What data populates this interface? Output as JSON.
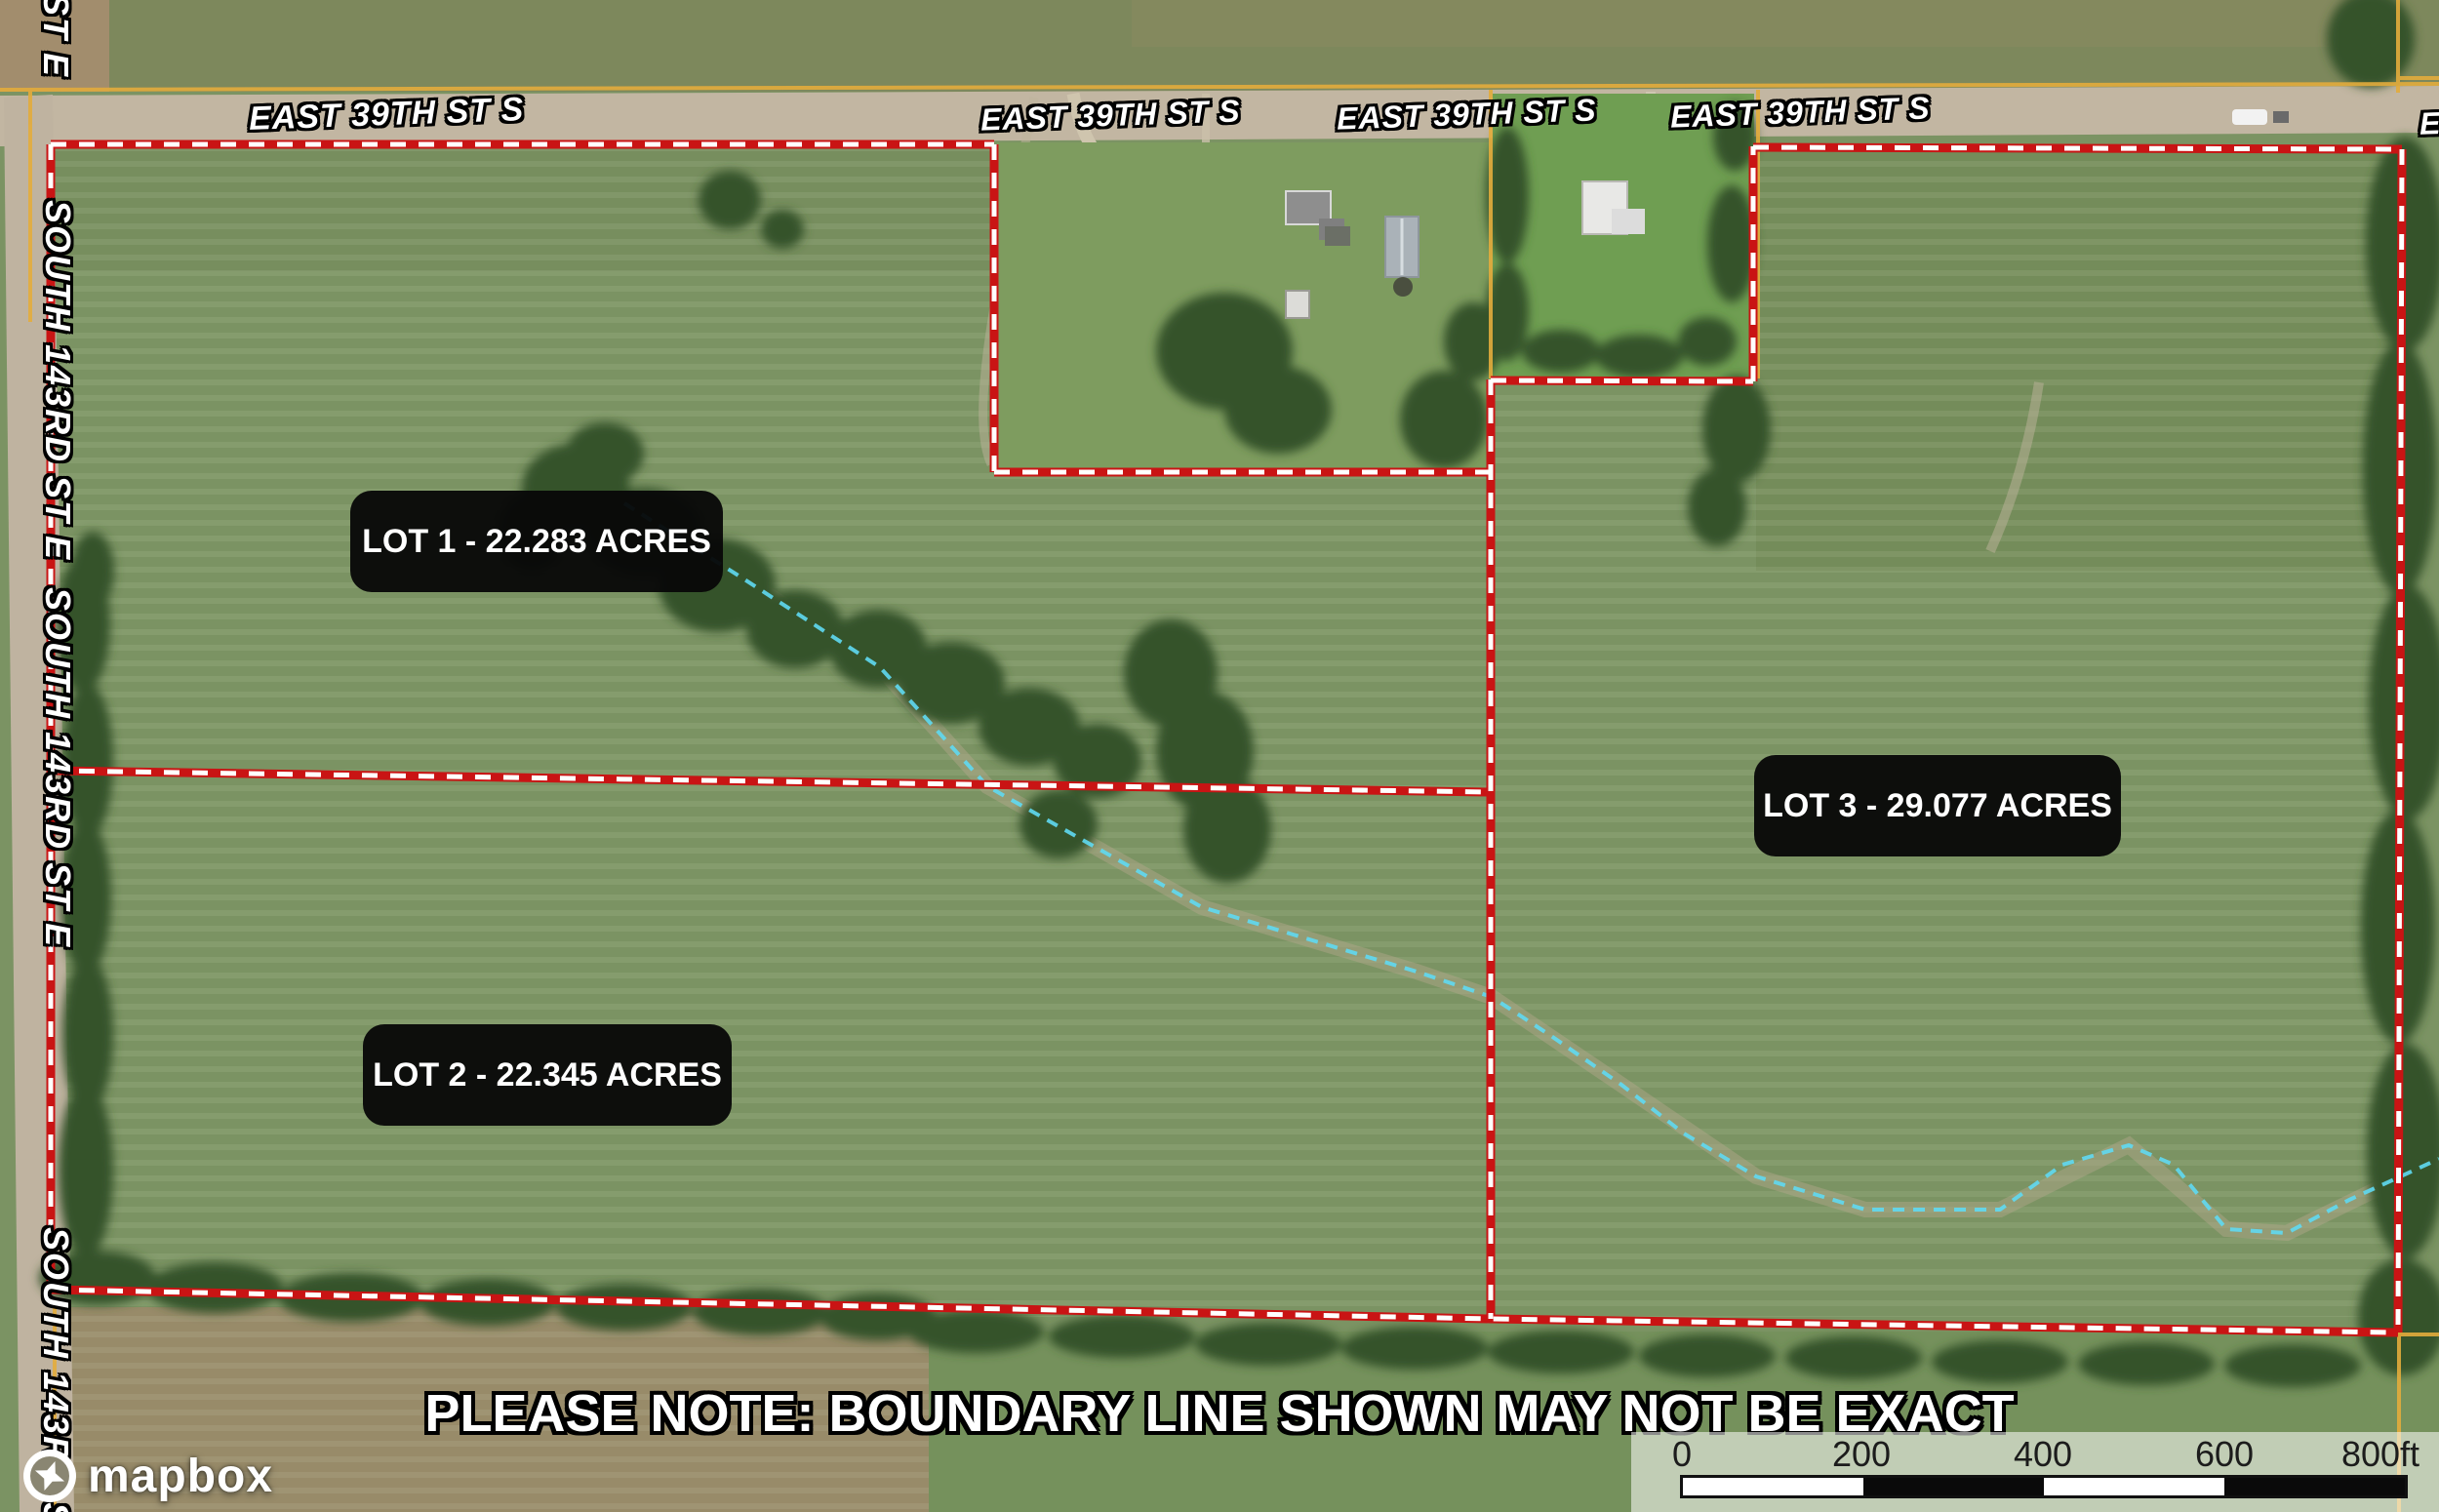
{
  "road_labels": [
    {
      "text": "EAST 39TH ST S"
    },
    {
      "text": "EAST 39TH ST S"
    },
    {
      "text": "EAST 39TH ST S"
    },
    {
      "text": "EAST 39TH ST S"
    },
    {
      "text": "EA"
    }
  ],
  "side_street_labels": [
    {
      "text": "D ST E"
    },
    {
      "text": "SOUTH 143RD ST E"
    },
    {
      "text": "SOUTH 143RD ST E"
    },
    {
      "text": "SOUTH 143RD ST"
    }
  ],
  "lots": [
    {
      "name": "LOT 1",
      "acres": "22.283",
      "label": "LOT 1 - 22.283 ACRES"
    },
    {
      "name": "LOT 2",
      "acres": "22.345",
      "label": "LOT 2 - 22.345 ACRES"
    },
    {
      "name": "LOT 3",
      "acres": "29.077",
      "label": "LOT 3 - 29.077 ACRES"
    }
  ],
  "disclaimer": "PLEASE NOTE: BOUNDARY LINE SHOWN MAY NOT BE EXACT",
  "scale_bar": {
    "ticks": [
      "0",
      "200",
      "400",
      "600"
    ],
    "end_label": "800ft"
  },
  "attribution": {
    "brand": "mapbox"
  },
  "colors": {
    "boundary_red": "#c91414",
    "boundary_dash": "#ffffff",
    "parcel_yellow": "#e3ac3c",
    "creek_cyan": "#5fd9f2",
    "label_bg": "#0a0a0a",
    "label_text": "#ffffff"
  }
}
